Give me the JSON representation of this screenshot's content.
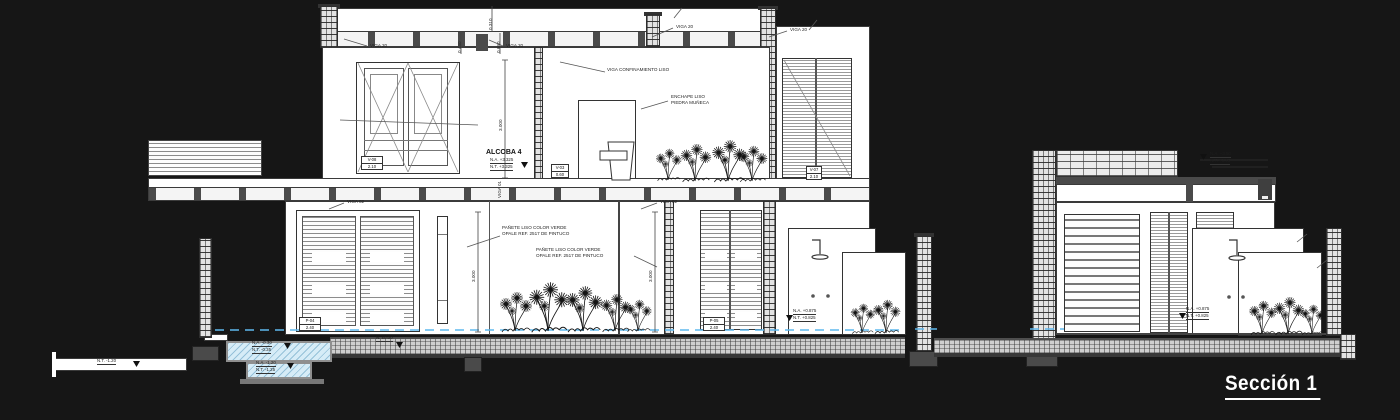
{
  "title": "Sección 1",
  "drawing": {
    "room_label": "ALCOBA 4",
    "annotations": {
      "beam_note": "VIGA CONFINAMIENTO LISO",
      "cladding_1": "ENCHAPE LISO",
      "cladding_2": "PIEDRA MUÑECA",
      "plaster_1": "PAÑETE LISO COLOR VERDE",
      "plaster_2": "OPALE REF. 2517 DE PINTUCO"
    },
    "beams": {
      "viga20": "VIGA 20",
      "viga02": "VIGA 02",
      "viga01": "VIGA 01"
    },
    "dims": {
      "d1": "0.310",
      "d2": "0.430",
      "d3": "0.680",
      "d4": "3.000"
    },
    "levels": {
      "alcoba_a": "N.A. +3.325",
      "alcoba_t": "N.T. +3.325",
      "pav_a": "N.A. +3.50",
      "pav_t": "N.T. +3.45",
      "pool_hi_a": "N.A. -0.30",
      "pool_hi_t": "N.T. -0.35",
      "pool_lo_a": "N.A. -1.20",
      "pool_lo_t": "N.T. -1.25",
      "terrain": "N.T. -1.20",
      "zero": "N. ±0.00",
      "shower_a": "N.A. +0.875",
      "shower_t": "N.T. +0.825"
    },
    "tags": {
      "t1": "V-08",
      "t1s": "2.10",
      "t2": "V-03",
      "t2s": "0.60",
      "t3": "P-04",
      "t3s": "2.40",
      "t4": "P-05",
      "t4s": "2.40",
      "t5": "V-07",
      "t5s": "2.10"
    },
    "colors": {
      "background": "#161616",
      "paper": "#ffffff",
      "line": "#3c3c3c",
      "water": "#d6ecf7",
      "water_line": "#5fb8ee"
    }
  }
}
